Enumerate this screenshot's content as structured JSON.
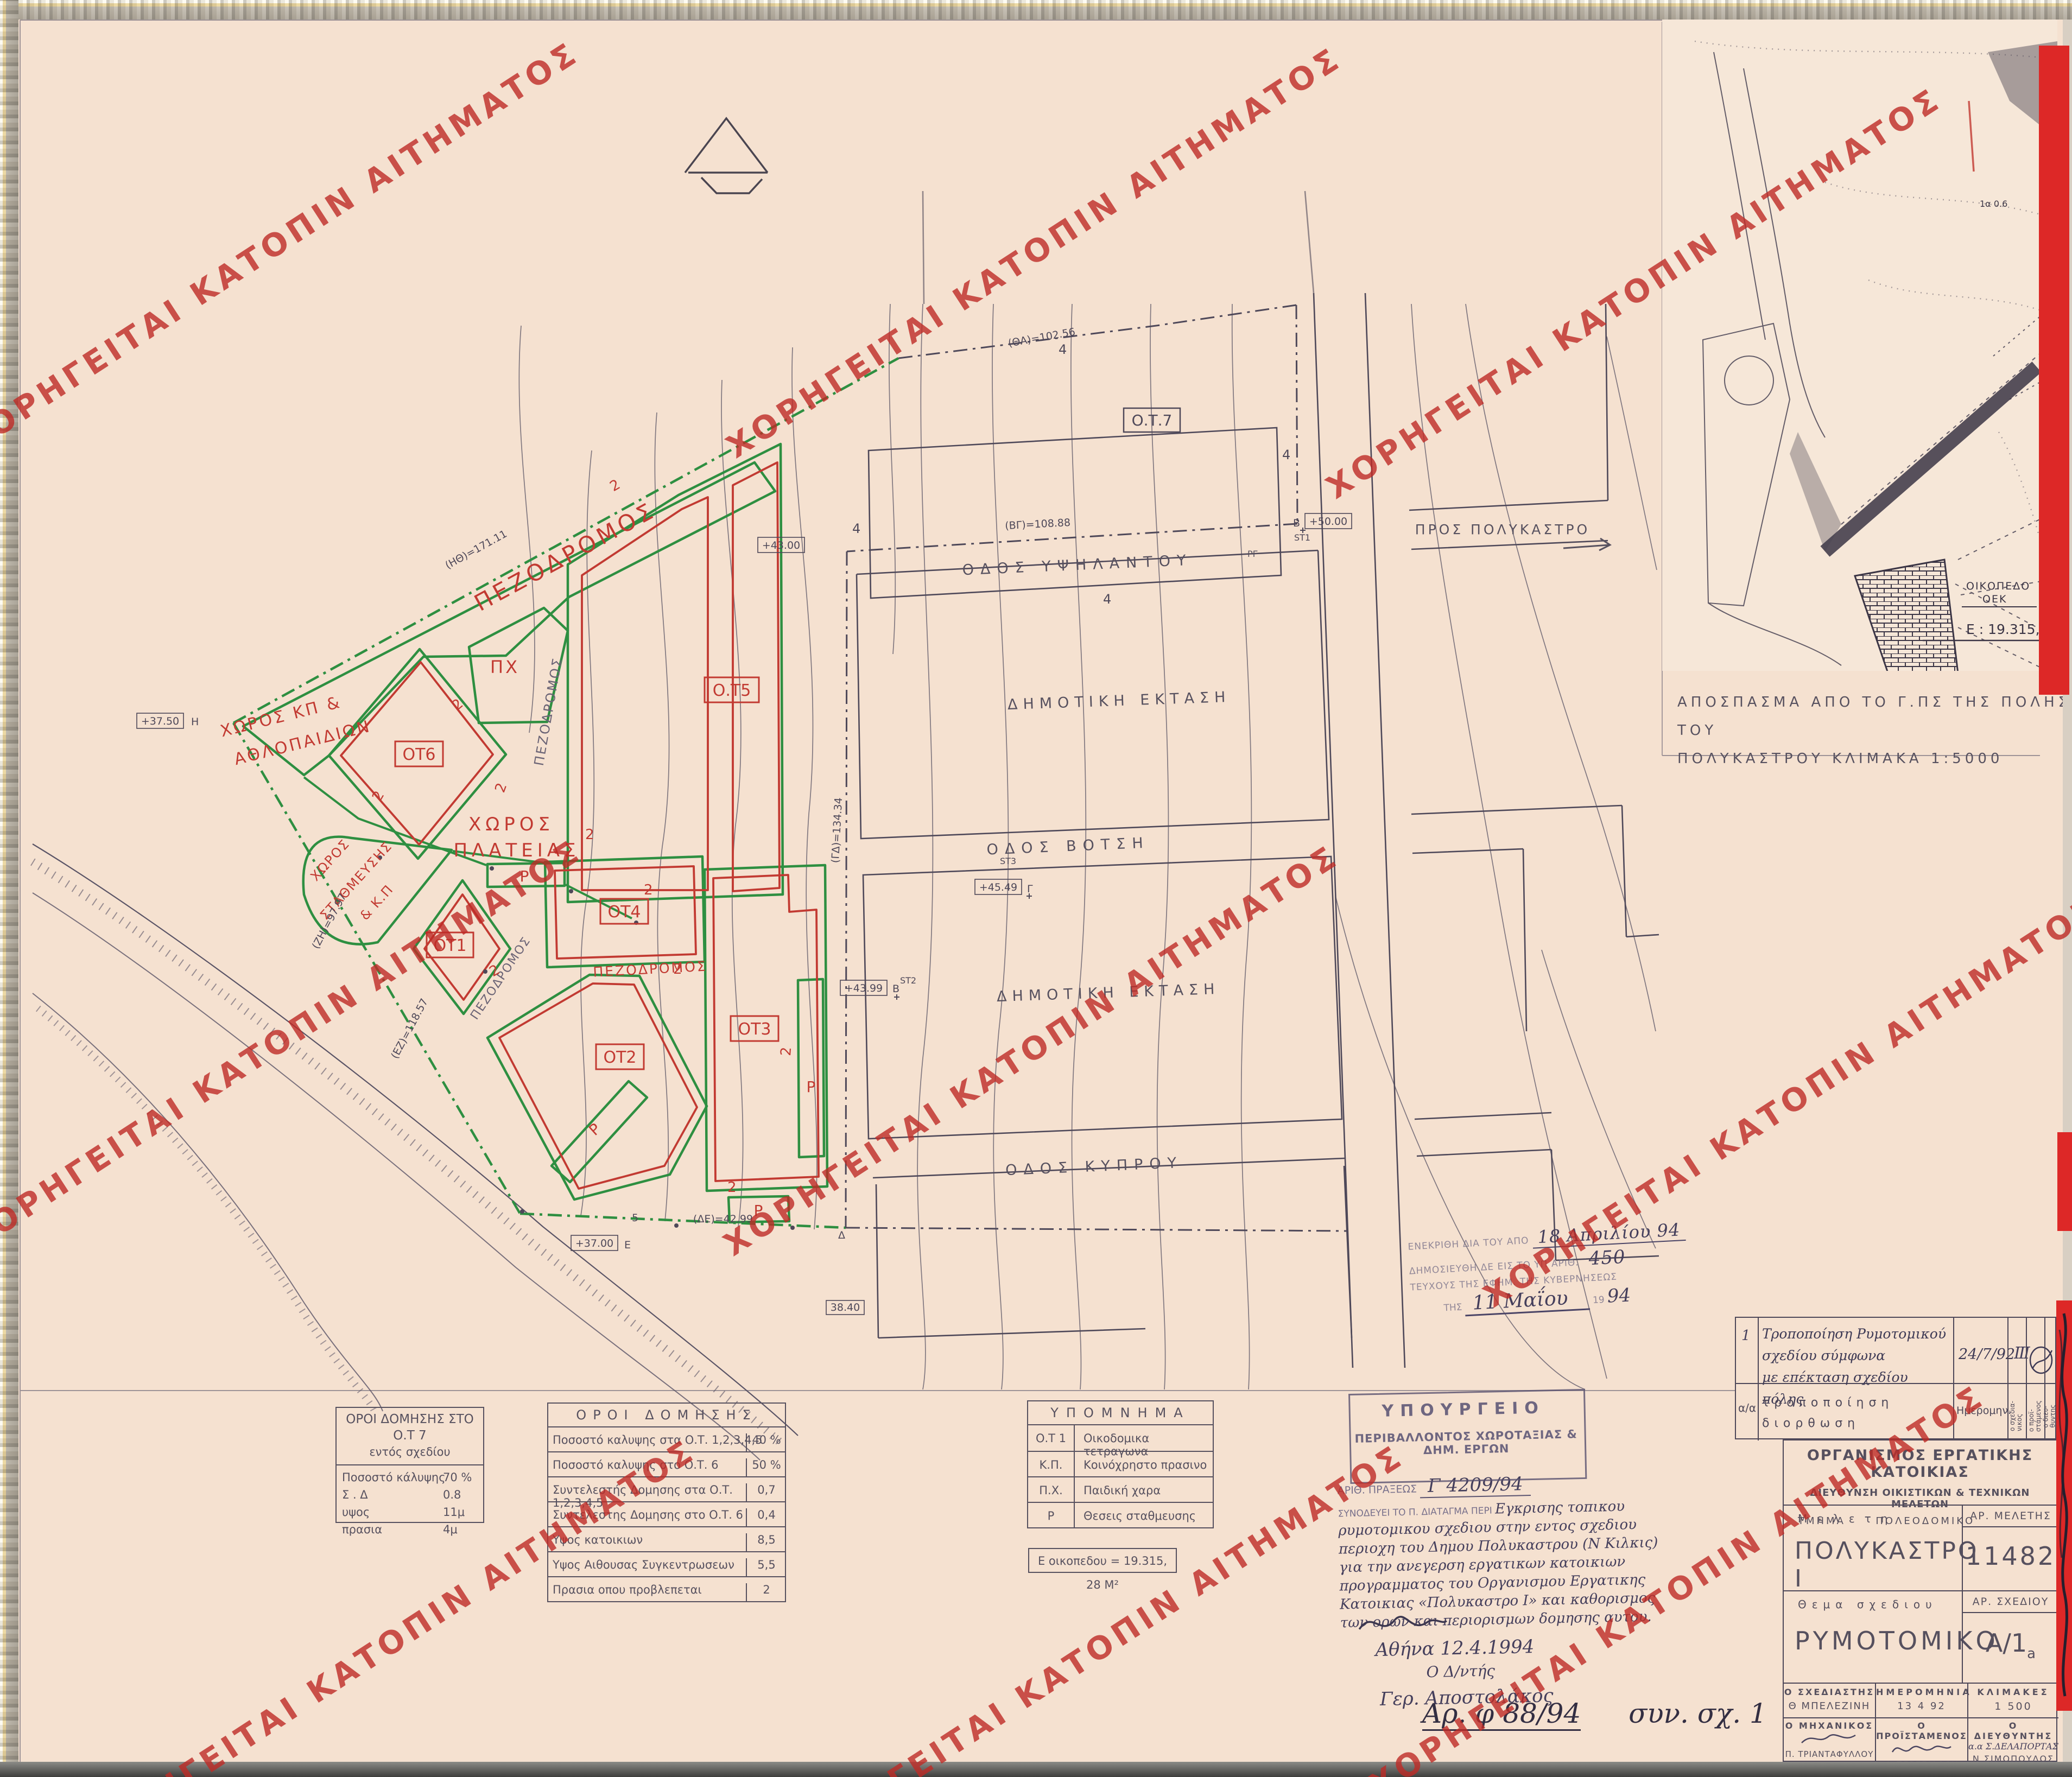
{
  "watermark": {
    "text": "ΧΟΡΗΓΕΙΤΑΙ ΚΑΤΟΠΙΝ ΑΙΤΗΜΑΤΟΣ",
    "color": "#be2a26"
  },
  "inset": {
    "caption1": "ΑΠΟΣΠΑΣΜΑ ΑΠΟ ΤΟ Γ.ΠΣ ΤΗΣ ΠΟΛΗΣ ΤΟΥ",
    "caption2": "ΠΟΛΥΚΑΣΤΡΟΥ ΚΛΙΜΑΚΑ 1:5000",
    "parcel1": "ΟΙΚΟΠΕΔΟ",
    "parcel2": "ΟΕΚ",
    "area": "Ε : 19.315,28 μ²",
    "mark1": "1α 0.6"
  },
  "map": {
    "streets": {
      "ypsilantou": "ΟΔΟΣ ΥΨΗΛΑΝΤΟΥ",
      "votsi": "ΟΔΟΣ ΒΟΤΣΗ",
      "kyprou": "ΟΔΟΣ ΚΥΠΡΟΥ",
      "pros_polykastro": "ΠΡΟΣ ΠΟΛΥΚΑΣΤΡΟ"
    },
    "areas": {
      "dimotiki": "ΔΗΜΟΤΙΚΗ ΕΚΤΑΣΗ",
      "plateia1": "ΧΩΡΟΣ",
      "plateia2": "ΠΛΑΤΕΙΑΣ",
      "kp1": "ΧΩΡΟΣ ΚΠ &",
      "kp2": "ΑΘΛΟΠΑΙΔΙΩΝ",
      "stathm1": "ΧΩΡΟΣ",
      "stathm2": "ΣΤΑΘΜΕΥΣΗΣ",
      "stathm3": "& Κ.Π",
      "pezodromos": "ΠΕΖΟΔΡΟΜΟΣ",
      "px": "ΠΧ",
      "parking": "Ρ"
    },
    "blocks": {
      "ot1": "ΟΤ1",
      "ot2": "ΟΤ2",
      "ot3": "ΟΤ3",
      "ot4": "ΟΤ4",
      "ot5": "Ο.Τ5",
      "ot6": "ΟΤ6",
      "ot7": "Ο.Τ.7"
    },
    "marks": {
      "dim": "2",
      "contour": "4",
      "h_level": "+37.50",
      "h_pt": "Η",
      "e_level": "+37.00",
      "e_pt": "Ε",
      "d_pt": "Δ",
      "pt5": "5",
      "st1": "ST1",
      "st1_pt": "Β",
      "st1_level": "+50.00",
      "st2": "ST2",
      "st2_pt": "Β",
      "st2_level": "+43.99",
      "st3": "ST3",
      "st3_pt": "Γ",
      "st3_level": "+45.49",
      "level_38": "38.40",
      "level_43": "+43.00",
      "len_ith": "(ΗΘ)=171.11",
      "len_zi": "(ΖΗ)=97.97",
      "len_ez": "(ΕΖ)=118.57",
      "len_gd": "(ΓΔ)=134.34",
      "len_de": "(ΔΕ)=42.99",
      "len_vg": "(ΒΓ)=108.88",
      "len_tha": "(ΘΑ)=102.56",
      "rg": "ΡΓ"
    }
  },
  "table_ot7": {
    "title1": "ΟΡΟΙ ΔΟΜΗΣΗΣ ΣΤΟ Ο.Τ 7",
    "title2": "εντός σχεδίου",
    "rows": [
      {
        "label": "Ποσοστό κάλυψης",
        "value": "70 %"
      },
      {
        "label": "Σ . Δ",
        "value": "0.8"
      },
      {
        "label": "υψος",
        "value": "11μ"
      },
      {
        "label": "πρασια",
        "value": "4μ"
      }
    ]
  },
  "table_oroi": {
    "title": "ΟΡΟΙ ΔΟΜΗΣΗΣ",
    "rows": [
      {
        "label": "Ποσοστό καλυψης στα Ο.Τ. 1,2,3,4,5",
        "value": "40 %"
      },
      {
        "label": "Ποσοστό καλυψης στο Ο.Τ. 6",
        "value": "50 %"
      },
      {
        "label": "Συντελεστής Δομησης στα Ο.Τ. 1,2,3,4,5",
        "value": "0,7"
      },
      {
        "label": "Συντελεστης Δομησης στο Ο.Τ. 6",
        "value": "0,4"
      },
      {
        "label": "Υψος κατοικιων",
        "value": "8,5"
      },
      {
        "label": "Υψος Αιθουσας Συγκεντρωσεων",
        "value": "5,5"
      },
      {
        "label": "Πρασια οπου προβλεπεται",
        "value": "2"
      }
    ]
  },
  "legend": {
    "title": "ΥΠΟΜΝΗΜΑ",
    "rows": [
      {
        "code": "Ο.Τ 1",
        "label": "Οικοδομικα τετραγωνα"
      },
      {
        "code": "Κ.Π.",
        "label": "Κοινόχρηστο πρασινο"
      },
      {
        "code": "Π.Χ.",
        "label": "Παιδική χαρα"
      },
      {
        "code": "Ρ",
        "label": "Θεσεις σταθμευσης"
      }
    ],
    "area_box": "Ε οικοπεδου = 19.315, 28 Μ²"
  },
  "ministry_stamp": {
    "line1": "ΥΠΟΥΡΓΕΙΟ",
    "line2": "ΠΕΡΙΒΑΛΛΟΝΤΟΣ ΧΩΡΟΤΑΞΙΑΣ & ΔΗΜ. ΕΡΓΩΝ",
    "praxis_label": "ΑΡΙΘ. ΠΡΑΞΕΩΣ",
    "praxis_no": "Γ 4209/94",
    "accompanies": "ΣΥΝΟΔΕΥΕΙ ΤΟ Π. ΔΙΑΤΑΓΜΑ ΠΕΡΙ",
    "hand1": "Εγκρισης τοπικου",
    "hand2": "ρυμοτομικου σχεδιου στην εντος σχεδιου",
    "hand3": "περιοχη του Δημου Πολυκαστρου (Ν Κιλκις)",
    "hand4": "για την ανεγερση εργατικων κατοικιων",
    "hand5": "προγραμματος του Οργανισμου Εργατικης",
    "hand6": "Κατοικιας «Πολυκαστρο Ι» και καθορισμος",
    "hand7": "των ορων και περιορισμων δομησης αυτου.",
    "date": "Αθήνα 12.4.1994",
    "sig_title": "Ο Δ/ντής",
    "sig_name": "Γερ. Αποστολάκος"
  },
  "approval_stamp": {
    "l1": "ΕΝΕΚΡΙΘΗ ΔΙΑ ΤΟΥ ΑΠΟ",
    "hw1": "18 Απριλίου 94",
    "l2": "ΔΗΜΟΣΙΕΥΘΗ ΔΕ ΕΙΣ ΤΟ ΥΠ ΑΡΙΘ.",
    "hw2": "450",
    "l3": "ΤΕΥΧΟΥΣ ΤΗΣ ΕΦΗΜ. ΤΗΣ ΚΥΒΕΡ­ΝΗΣΕΩΣ",
    "l4": "ΤΗΣ",
    "hw3": "11 Μαΐου",
    "l5": "19",
    "hw4": "94"
  },
  "revision": {
    "row_no": "1",
    "desc1": "Τροποποίηση Ρυμοτομικού σχεδίου σύμφωνα",
    "desc2": "με επέκταση σχεδίου πόλης",
    "date": "24/7/92",
    "tally": "III",
    "head_no": "α/α",
    "head_desc1": "τροποποίηση",
    "head_desc2": "διορθωση",
    "head_date": "Ημερομην.",
    "sig_col1a": "ο σχεδια-",
    "sig_col1b": "νικος",
    "sig_col2a": "ο προϊ-",
    "sig_col2b": "στάμενος",
    "sig_col3a": "ο διευ-",
    "sig_col3b": "θυντης"
  },
  "titleblock": {
    "org": "ΟΡΓΑΝΙΣΜΟΣ ΕΡΓΑΤΙΚΗΣ ΚΑΤΟΙΚΙΑΣ",
    "dir": "ΔΙΕΥΘΥΝΣΗ ΟΙΚΙΣΤΙΚΩΝ & ΤΕΧΝΙΚΩΝ ΜΕΛΕΤΩΝ",
    "dept_label": "ΤΜΗΜΑ",
    "dept": "ΠΟΛΕΟΔΟΜΙΚΟ",
    "study_label": "Μελετη",
    "study": "ΠΟΛΥΚΑΣΤΡΟ Ι",
    "study_no_label": "ΑΡ. ΜΕΛΕΤΗΣ",
    "study_no": "11482",
    "subject_label": "Θεμα σχεδιου",
    "subject": "ΡΥΜΟΤΟΜΙΚΟ",
    "drawing_no_label": "ΑΡ. ΣΧΕΔΙΟΥ",
    "drawing_no_main": "Α/1",
    "drawing_no_sub": "a",
    "designer_label": "Ο ΣΧΕΔΙΑΣΤΗΣ",
    "designer": "Θ ΜΠΕΛΕΖΙΝΗ",
    "date_label": "ΗΜΕΡΟΜΗΝΙΑ",
    "date": "13 4 92",
    "scale_label": "ΚΛΙΜΑΚΕΣ",
    "scale": "1 500",
    "engineer_label": "Ο ΜΗΧΑΝΙΚΟΣ",
    "engineer": "Π. ΤΡΙΑΝΤΑΦΥΛΛΟΥ",
    "supervisor_label": "Ο ΠΡΟΪΣΤΑΜΕΝΟΣ",
    "supervisor": "Φ ΠΕΡΕΣΙΑΔΟΥ",
    "director_label": "Ο ΔΙΕΥΘΥΝΤΗΣ",
    "director_aa": "α.α Σ.ΔΕΛΑΠΟΡΤΑΣ",
    "director": "Ν ΣΙΜΟΠΟΥΛΟΣ"
  },
  "note": {
    "part1": "Αρ. φ 88/94",
    "part2": "συν. σχ. 1"
  }
}
